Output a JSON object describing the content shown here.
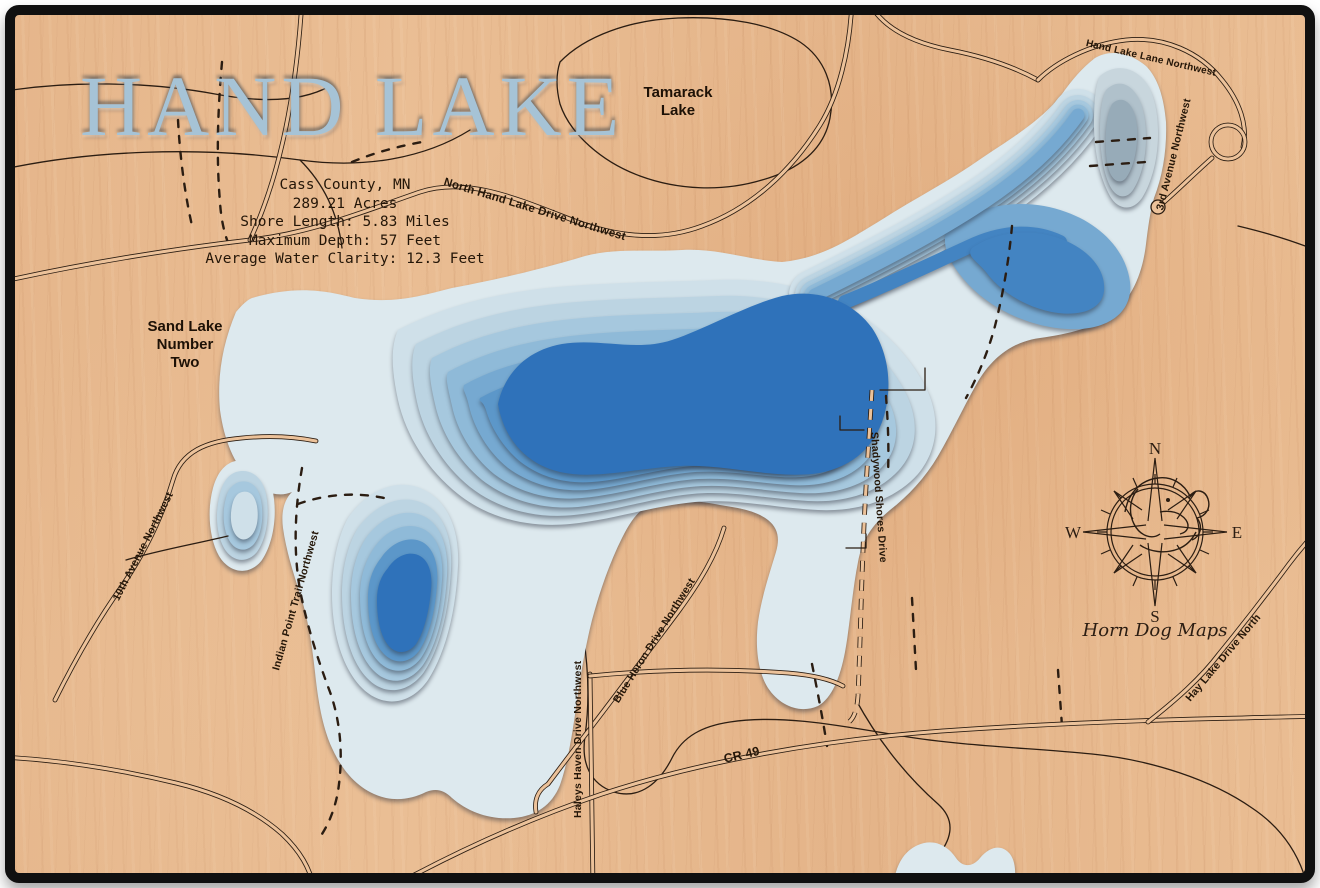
{
  "title": "HAND LAKE",
  "stats": {
    "county": "Cass County, MN",
    "acres": "289.21 Acres",
    "shore_length": "Shore Length: 5.83 Miles",
    "max_depth": "Maximum Depth: 57 Feet",
    "water_clarity": "Average Water Clarity: 12.3 Feet"
  },
  "lake_labels": {
    "tamarack": "Tamarack\nLake",
    "sand": "Sand Lake\nNumber\nTwo"
  },
  "roads": [
    {
      "label": "North Hand Lake Drive Northwest"
    },
    {
      "label": "Hand Lake Lane Northwest"
    },
    {
      "label": "3rd Avenue Northwest"
    },
    {
      "label": "10th Avenue Northwest"
    },
    {
      "label": "Indian Point Trail Northwest"
    },
    {
      "label": "Blue Heron Drive Northwest"
    },
    {
      "label": "Haleys Haven Drive Northwest"
    },
    {
      "label": "Shadywood Shores Drive"
    },
    {
      "label": "CR 49"
    },
    {
      "label": "Hay Lake Drive North"
    }
  ],
  "compass": {
    "north": "N",
    "east": "E",
    "south": "S",
    "west": "W"
  },
  "brand": "Horn Dog Maps",
  "colors": {
    "wood": "#e9bc92",
    "frame": "#101010",
    "engraving": "#2b1d12",
    "title_inlay": "#a6c3d6",
    "depth_palette": [
      "#dde9ee",
      "#cfe0e9",
      "#bcd4e2",
      "#a6c8de",
      "#8fbad8",
      "#76a9d1",
      "#5c97c9",
      "#4384c2",
      "#2f72ba"
    ],
    "pool_palette": [
      "#c8d6dd",
      "#b0c1cb",
      "#97abb8"
    ]
  }
}
